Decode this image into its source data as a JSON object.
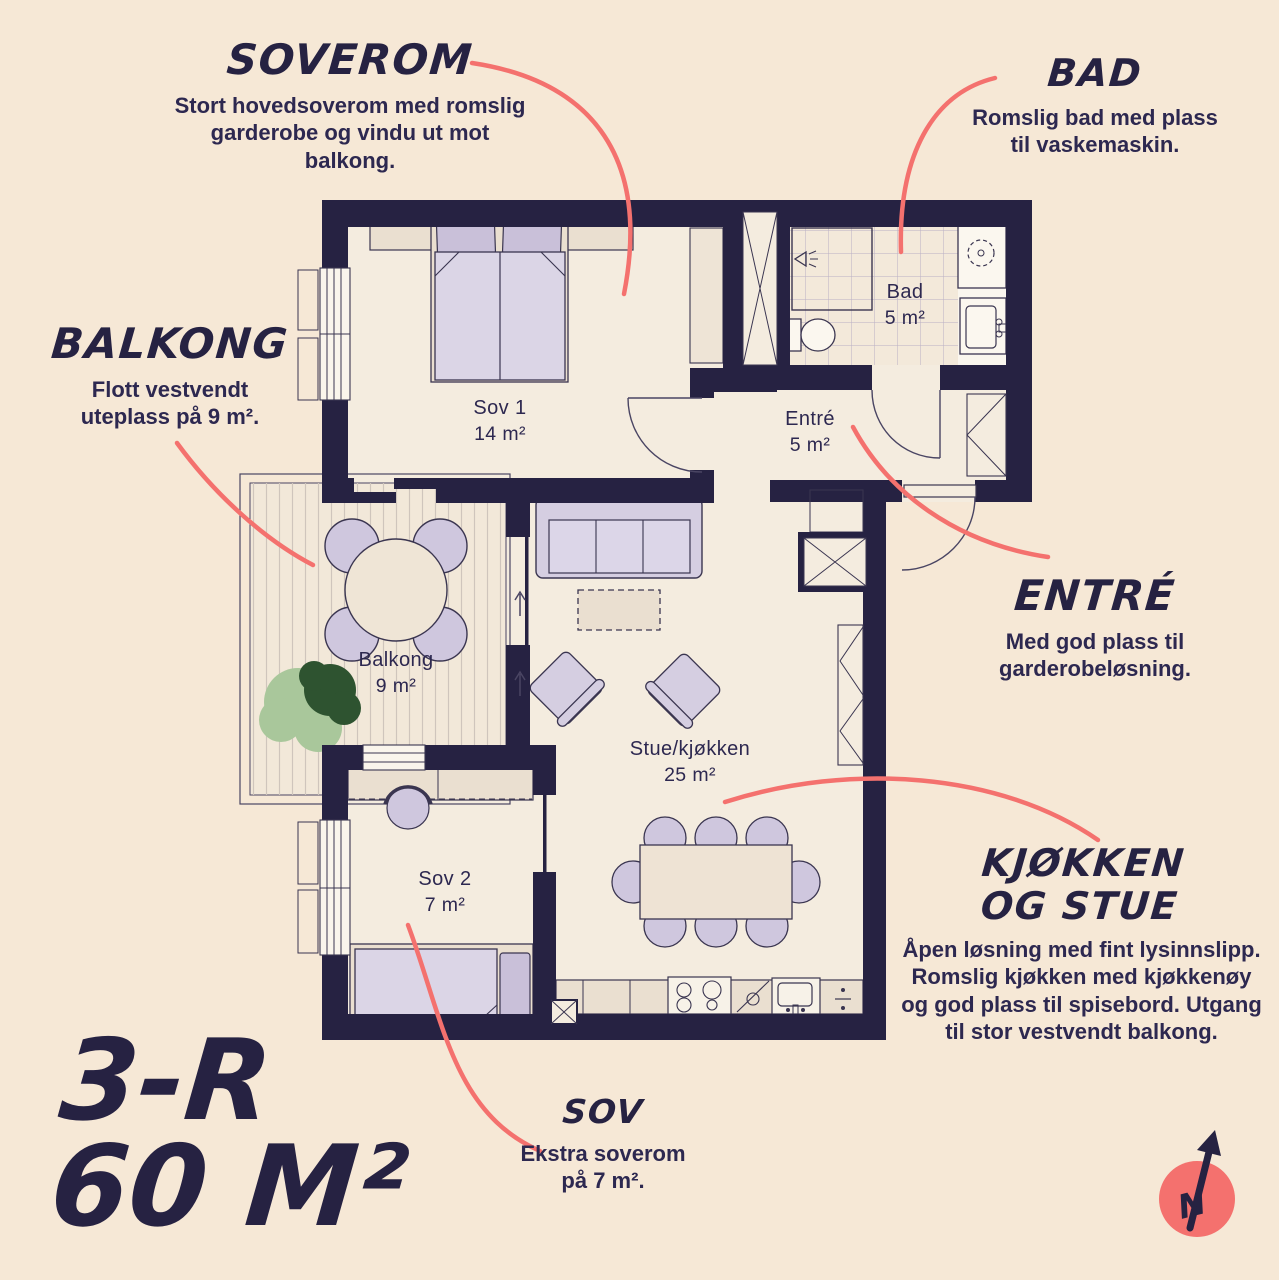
{
  "colors": {
    "background": "#f6e8d6",
    "floor": "#f4ecdf",
    "wall": "#262242",
    "accent_red": "#f4716e",
    "furniture_purple": "#d5cee1",
    "furniture_cream": "#eadfd0",
    "plant_light": "#a9c79b",
    "plant_dark": "#2e5330",
    "text": "#2d2850"
  },
  "annotations": {
    "soverom": {
      "title": "SOVEROM",
      "body": "Stort hovedsoverom med romslig garderobe og vindu ut mot balkong."
    },
    "bad": {
      "title": "BAD",
      "body": "Romslig bad med plass til vaskemaskin."
    },
    "balkong": {
      "title": "BALKONG",
      "body": "Flott vestvendt uteplass på 9 m²."
    },
    "entre": {
      "title": "ENTRÉ",
      "body": "Med god plass til garderobeløsning."
    },
    "kjokken": {
      "title_line1": "KJØKKEN",
      "title_line2": "OG STUE",
      "body": "Åpen løsning med fint lysinnslipp. Romslig kjøkken med kjøkkenøy og god plass til spisebord. Utgang til stor vestvendt balkong."
    },
    "sov": {
      "title": "SOV",
      "body": "Ekstra soverom på 7 m²."
    }
  },
  "plan": {
    "type_label": "3-R",
    "size_label": "60 M²",
    "rooms": [
      {
        "id": "sov1",
        "name": "Sov 1",
        "area": "14 m²"
      },
      {
        "id": "bad",
        "name": "Bad",
        "area": "5 m²"
      },
      {
        "id": "entre",
        "name": "Entré",
        "area": "5 m²"
      },
      {
        "id": "balkong",
        "name": "Balkong",
        "area": "9 m²"
      },
      {
        "id": "stue",
        "name": "Stue/kjøkken",
        "area": "25 m²"
      },
      {
        "id": "sov2",
        "name": "Sov 2",
        "area": "7 m²"
      }
    ]
  },
  "compass": {
    "label": "N"
  }
}
